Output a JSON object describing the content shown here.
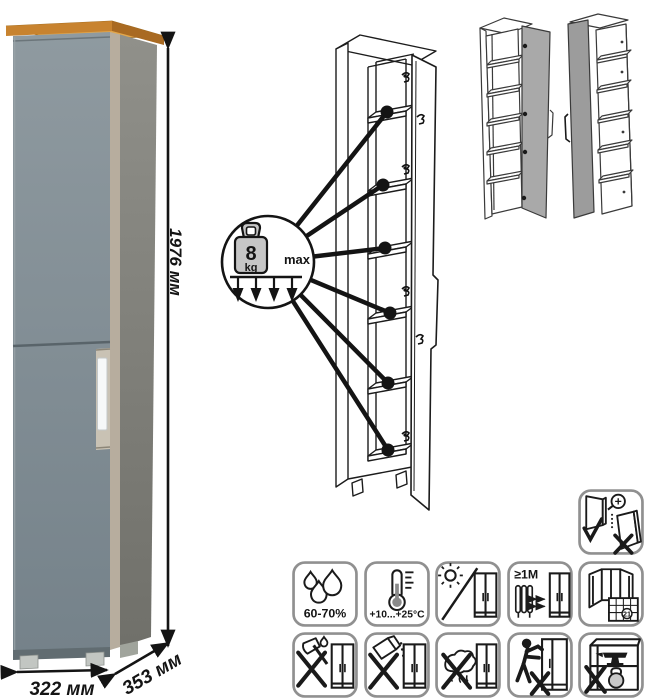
{
  "dims": {
    "height": "1976 мм",
    "width": "322 мм",
    "depth": "353 мм"
  },
  "shelf_load": {
    "value": "8",
    "unit": "kg",
    "qualifier": "max",
    "pointer_count": 6
  },
  "variants": {
    "count": 2,
    "names": [
      "open-carcass-door-right",
      "open-carcass-door-left"
    ]
  },
  "care_icons": {
    "adjustment": {
      "name": "door-adjustment-icon"
    },
    "row1": [
      {
        "name": "humidity-icon",
        "label": "60-70%"
      },
      {
        "name": "temperature-icon",
        "label": "+10...+25°C"
      },
      {
        "name": "no-direct-sunlight-icon",
        "label": ""
      },
      {
        "name": "heat-source-distance-icon",
        "label": "≥1М"
      },
      {
        "name": "ventilation-icon",
        "label": "21"
      }
    ],
    "row2": [
      {
        "name": "no-sharp-impact-icon"
      },
      {
        "name": "no-abrasive-cleaners-icon"
      },
      {
        "name": "no-wet-cleaning-icon"
      },
      {
        "name": "no-dragging-icon"
      },
      {
        "name": "no-overload-icon"
      }
    ]
  },
  "colors": {
    "door_front": "#7f8b91",
    "cabinet_side": "#83837d",
    "wood_top": "#c8832f",
    "handle": "#f4f6f6",
    "line": "#1a1a1a",
    "icon_border": "#909090",
    "variant_door_gray": "#a6a6a6"
  }
}
